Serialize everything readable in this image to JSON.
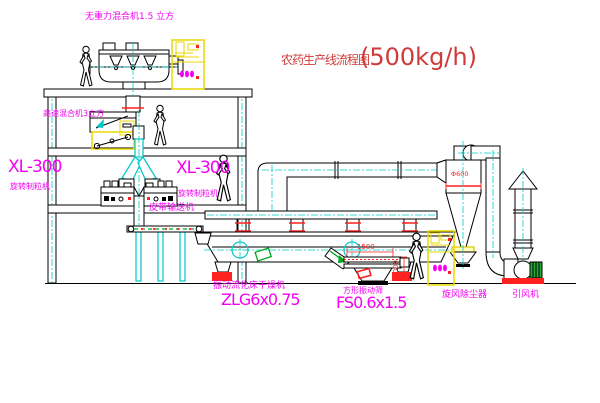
{
  "title": {
    "main": "农药生产线流程图",
    "capacity": "(500kg/h)"
  },
  "labels": {
    "gravity_mixer": "无重力混合机1.5 立方",
    "high_speed_mixer": "高速混合机3立方",
    "granulator_left_model": "XL-300",
    "granulator_left_name": "旋转制粒机",
    "granulator_right_model": "XL-300",
    "granulator_right_name": "旋转制粒机",
    "belt_conveyor": "皮带输送机",
    "dryer_name": "振动流化床干燥机",
    "dryer_model": "ZLG6x0.75",
    "sieve_name": "方形振动筛",
    "sieve_model": "FS0.6x1.5",
    "cyclone_name": "旋风除尘器",
    "fan_name": "引风机"
  },
  "dimensions": {
    "sieve_length": "1500",
    "sieve_width": "600",
    "cyclone_note": "Φ600"
  },
  "colors": {
    "label_magenta": "#f400f4",
    "title_red": "#cf3a3a",
    "line_black": "#000000",
    "centerline_cyan": "#00cccc",
    "cabinet_yellow": "#e8d800",
    "flange_red": "#ff2020",
    "motor_green": "#22aa33"
  }
}
